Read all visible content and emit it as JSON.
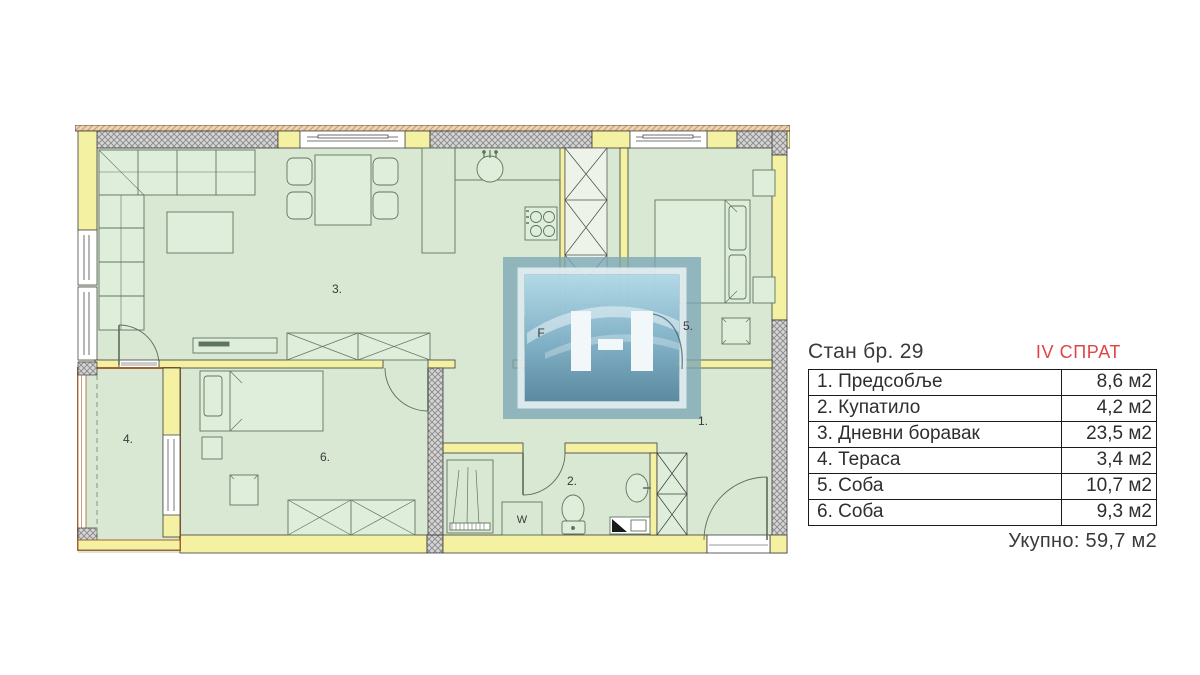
{
  "panel": {
    "title": "Стан бр. 29",
    "floor": "IV СПРАТ",
    "rows": [
      {
        "name": "1. Предсобље",
        "area": "8,6 м2"
      },
      {
        "name": "2. Купатило",
        "area": "4,2 м2"
      },
      {
        "name": "3. Дневни боравак",
        "area": "23,5 м2"
      },
      {
        "name": "4. Тераса",
        "area": "3,4 м2"
      },
      {
        "name": "5. Соба",
        "area": "10,7 м2"
      },
      {
        "name": "6. Соба",
        "area": "9,3 м2"
      }
    ],
    "total": "Укупно: 59,7 м2"
  },
  "plan": {
    "labels": {
      "hallway": "1.",
      "bathroom": "2.",
      "living": "3.",
      "terrace": "4.",
      "bedroom_big": "5.",
      "bedroom_small": "6.",
      "fridge": "F",
      "washer": "W"
    },
    "colors": {
      "room_fill": "#d9e8d2",
      "wall_yellow": "#f5f1a3",
      "hatch_gray": "#d6d6d6",
      "terrace_wall": "#a5622f",
      "accent_red": "#e04545",
      "watermark_blue": "#7ba6b5",
      "outline": "#2a2a2a"
    }
  }
}
